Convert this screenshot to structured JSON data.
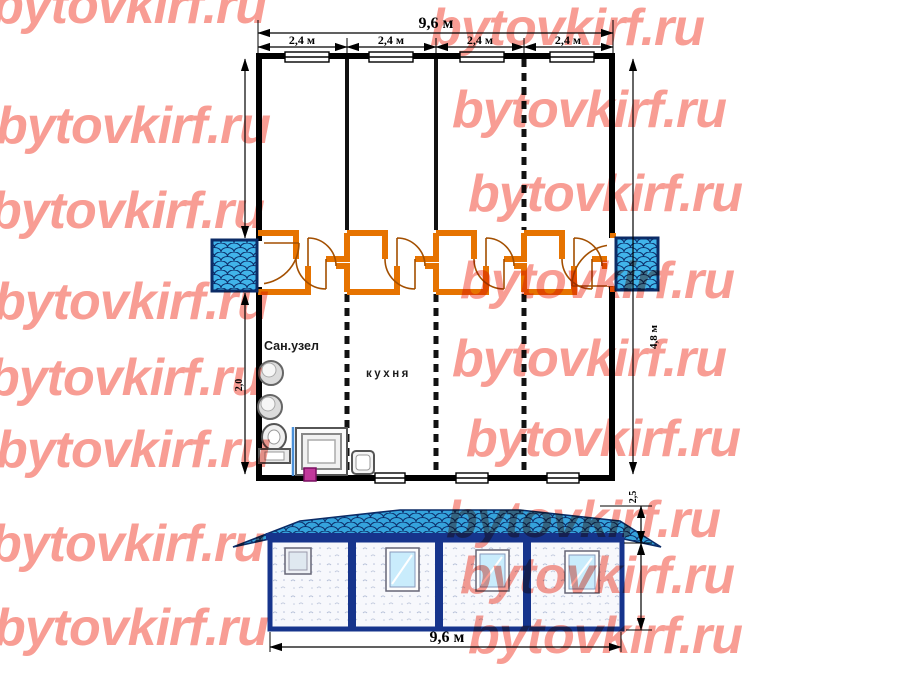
{
  "watermark": {
    "text": "bytovkirf.ru",
    "color": "#f89d94"
  },
  "plan": {
    "total_length_label": "9,6 м",
    "module_labels": [
      "2,4 м",
      "2,4 м",
      "2,4 м",
      "2,4 м"
    ],
    "width_label": "4,8 м",
    "room_depth_label": "2,0",
    "rooms": {
      "bathroom": "Сан.узел",
      "kitchen": "кухня"
    }
  },
  "elevation": {
    "length_label": "9,6 м",
    "height_label": "2,5"
  },
  "colors": {
    "corridor_wall": "#e67300",
    "door_arc": "#a34f00",
    "porch_fill": "#41b4ea",
    "roof_fill": "#35a3dc",
    "frame_navy": "#16348c",
    "scale_stroke": "#0c2f6b"
  }
}
